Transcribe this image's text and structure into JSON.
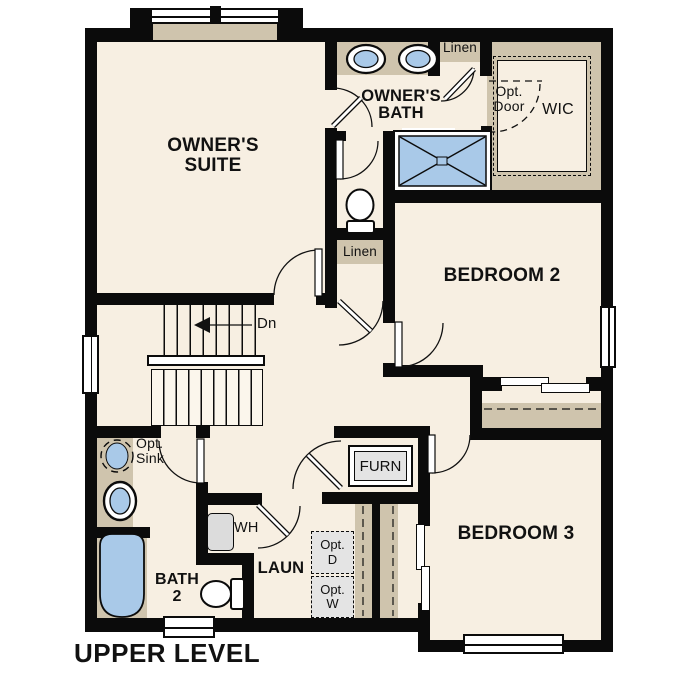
{
  "title": "UPPER LEVEL",
  "colors": {
    "floor": "#f7efe2",
    "wall": "#0b0b0b",
    "tan": "#cfc4ad",
    "fixture_blue": "#a9c9e8",
    "appliance_gray": "#e4e4e4"
  },
  "rooms": {
    "owners_suite": {
      "label": "OWNER'S SUITE"
    },
    "owners_bath": {
      "label": "OWNER'S BATH"
    },
    "bedroom_2": {
      "label": "BEDROOM 2"
    },
    "bedroom_3": {
      "label": "BEDROOM 3"
    },
    "bath_2": {
      "label": "BATH 2"
    },
    "laundry": {
      "label": "LAUN"
    },
    "wic": {
      "label": "WIC"
    }
  },
  "features": {
    "linen_top": "Linen",
    "linen_mid": "Linen",
    "furnace": "FURN",
    "water_heater": "WH",
    "opt_door": "Opt. Door",
    "opt_sink": "Opt. Sink",
    "opt_dryer": "Opt. D",
    "opt_washer": "Opt. W",
    "stairs_direction": "Dn"
  }
}
